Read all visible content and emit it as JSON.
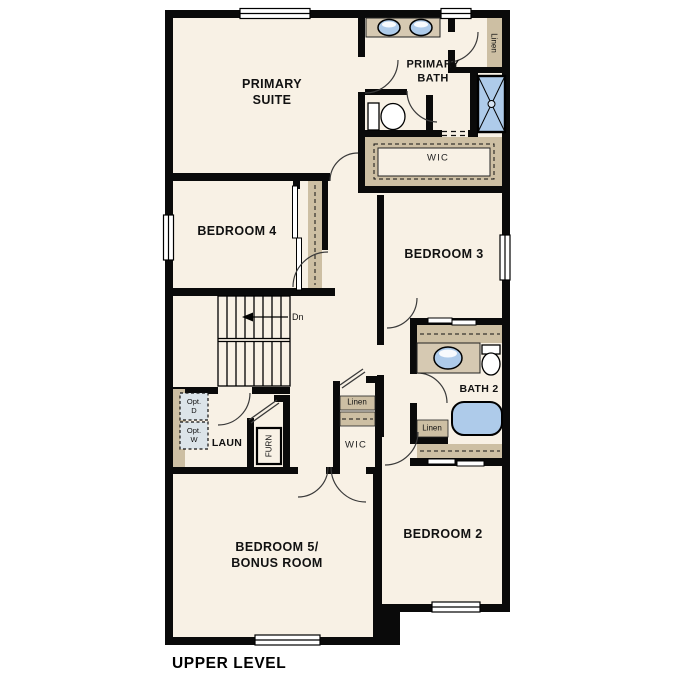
{
  "plan_title": "UPPER LEVEL",
  "colors": {
    "floor": "#f8f1e5",
    "wall": "#0a0a0a",
    "cabinet_tan": "#cdbfa3",
    "counter_tan": "#d6c9b2",
    "fixture_blue": "#aecbea",
    "optional_appliance_fill": "#dce4e9"
  },
  "labels": {
    "primary_suite": "PRIMARY\nSUITE",
    "primary_bath": "PRIMARY\nBATH",
    "bedroom_4": "BEDROOM 4",
    "bedroom_3": "BEDROOM 3",
    "bedroom_2": "BEDROOM 2",
    "bedroom_5": "BEDROOM 5/\nBONUS ROOM",
    "bath_2": "BATH 2",
    "laundry": "LAUN",
    "wic_primary": "WIC",
    "wic_bedroom5": "WIC",
    "linen_upper": "Linen",
    "linen_hall": "Linen",
    "linen_bath2": "Linen",
    "furnace": "FURN",
    "stairs_direction": "Dn",
    "optional_dryer": "Opt.\nD",
    "optional_washer": "Opt.\nW",
    "plan_title": "UPPER LEVEL"
  }
}
